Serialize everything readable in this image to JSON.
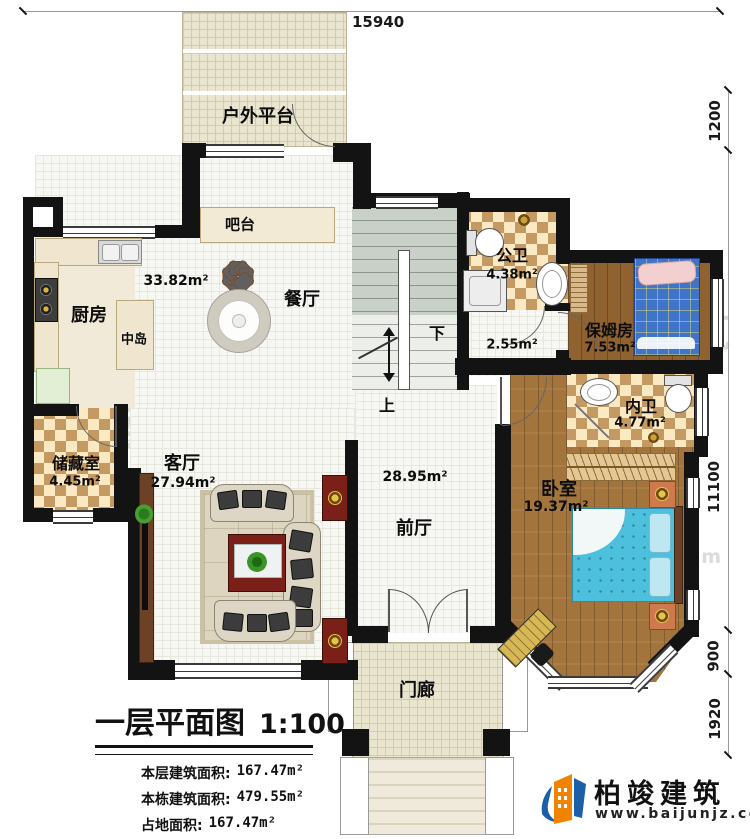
{
  "plan_title": {
    "title": "一层平面图",
    "scale": "1:100"
  },
  "legend": {
    "stats": [
      {
        "label": "本层建筑面积:",
        "value": "167.47m²"
      },
      {
        "label": "本栋建筑面积:",
        "value": "479.55m²"
      },
      {
        "label": "占地面积:",
        "value": "167.47m²"
      },
      {
        "label": "层高:",
        "value": "3.6m"
      }
    ]
  },
  "dimensions": {
    "top": "15940",
    "right": [
      "1200",
      "11100",
      "900",
      "1920"
    ]
  },
  "rooms": {
    "outdoor_platform": {
      "name": "户外平台"
    },
    "bar": {
      "name": "吧台"
    },
    "kitchen": {
      "name": "厨房"
    },
    "island": {
      "name": "中岛"
    },
    "dining": {
      "name": "餐厅",
      "area": "33.82m²"
    },
    "public_bath": {
      "name": "公卫",
      "area": "4.38m²"
    },
    "corridor": {
      "area": "2.55m²"
    },
    "nanny_room": {
      "name": "保姆房",
      "area": "7.53m²"
    },
    "inner_bath": {
      "name": "内卫",
      "area": "4.77m²"
    },
    "storage": {
      "name": "储藏室",
      "area": "4.45m²"
    },
    "living": {
      "name": "客厅",
      "area": "27.94m²"
    },
    "front_hall": {
      "name": "前厅",
      "area": "28.95m²"
    },
    "bedroom": {
      "name": "卧室",
      "area": "19.37m²"
    },
    "porch": {
      "name": "门廊"
    }
  },
  "stairs": {
    "down": "下",
    "up": "上"
  },
  "brand": {
    "name": "柏竣建筑",
    "url": "www.baijunjz.com"
  },
  "watermark": {
    "text": "柏竣建筑",
    "url": "www.baijunjz.com"
  },
  "colors": {
    "wall": "#131313",
    "checker_dark": "#c59a62",
    "checker_light": "#fae9c3",
    "wood": "#a3743c",
    "bed_blue": "#4cc0dd",
    "nanny_bed_blue": "#3f74c8",
    "accent_red": "#7a2018",
    "brand_blue": "#1b5fa8",
    "brand_orange": "#f08300"
  }
}
